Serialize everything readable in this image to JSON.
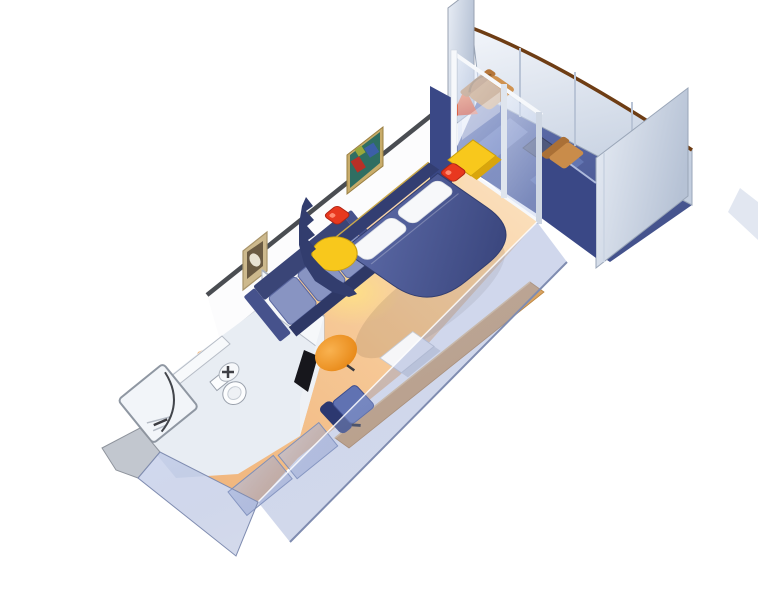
{
  "scene": {
    "type": "stateroom-3d-cutaway-floorplan",
    "areas": [
      "entry",
      "bathroom",
      "wardrobe",
      "sitting-area",
      "sleeping-area",
      "desk-area",
      "balcony"
    ],
    "furniture": [
      "entry-door",
      "shower",
      "toilet",
      "sink",
      "wardrobe-doors",
      "sofa",
      "wall-art",
      "ottoman",
      "queen-bed",
      "pillows",
      "nightstands",
      "table-lamps",
      "desk",
      "desk-chair",
      "tv-cabinet",
      "glass-sliding-door",
      "deck-chairs",
      "deck-table",
      "balcony-railing"
    ]
  },
  "colors": {
    "background": "#ffffff",
    "wall_face": "#fcfcfd",
    "wall_cap": "#4a4d52",
    "wall_base_line": "#c9cdd4",
    "floor_light": "#fbe3c2",
    "floor_warm": "#f6c896",
    "floor_deep": "#efb278",
    "balcony_light": "#6272b0",
    "balcony_dark": "#44528c",
    "navy_wall": "#3a4886",
    "glass_light": "rgba(236,242,252,0.62)",
    "glass_dark": "rgba(182,198,234,0.45)",
    "glass_frame": "#f6f8fb",
    "railing_light": "#f2f5fa",
    "railing_shade": "#c3cedf",
    "railing_cap_brown": "#6e3d14",
    "divider_light": "#e8edf5",
    "divider_shade": "#b6c2d5",
    "bed_light": "#5d6ba8",
    "bed_dark": "#3c4880",
    "headboard": "#333e72",
    "headboard_trim": "#c9a84c",
    "pillow_white": "#f7f8fa",
    "sofa_frame": "#3a4577",
    "sofa_cushion": "#8894c2",
    "sofa_dark": "#2e3866",
    "sofa_arm": "#46528c",
    "partition_navy": "#323d6e",
    "nightstand_yellow": "#f8c81c",
    "nightstand_side": "#d9a50c",
    "lamp_red": "#e8381f",
    "lamp_highlight": "#ff8a70",
    "ottoman_light": "#f9b250",
    "ottoman_deep": "#e5820e",
    "chair_blue": "#6072b2",
    "chair_navy": "#2c3870",
    "desk_tan": "#d9a360",
    "desk_highlight": "#efc88c",
    "tv_white": "#f6f6f8",
    "tv_side": "#d6d9e0",
    "wardrobe_glass_light": "rgba(178,192,228,0.62)",
    "wardrobe_glass_dark": "rgba(136,152,202,0.45)",
    "wardrobe_edge": "#8090b8",
    "trans_wall_light": "rgba(172,186,226,0.55)",
    "trans_wall_dark": "rgba(128,146,198,0.35)",
    "trans_wall_edge": "#7f8cb0",
    "bath_floor": "#e8edf3",
    "bath_wall": "#f6f8fa",
    "fixture_white": "#fcfdfe",
    "fixture_line": "#9aa1ac",
    "doorway_dark": "#17171c",
    "entry_sill_gray": "#c2c7cf",
    "cone_orange_light": "#ff7a36",
    "cone_orange_deep": "#dd3410",
    "deck_tan": "#cf9250",
    "deck_tan_dark": "#b5763a",
    "deck_table": "#50597c",
    "art1_frame": "#cdb98d",
    "art1_fill": "#6a5a42",
    "art1_blob": "#e8e2d2",
    "art2_frame": "#c8ac6a",
    "art2_fill": "#2f6e62",
    "art2_red": "#b83026",
    "art2_blue": "#3c5fa8",
    "art2_green": "#9aa83c",
    "glow_yellow": "#ffe482",
    "shadow": "rgba(100,80,60,0.15)"
  }
}
